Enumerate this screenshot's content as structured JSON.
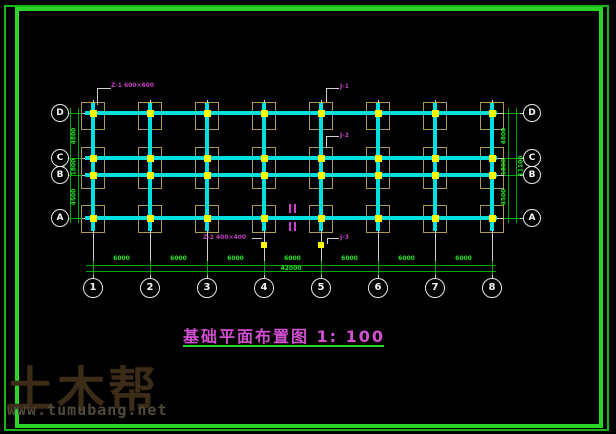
{
  "drawing": {
    "title": "基础平面布置图 1: 100",
    "axes": {
      "columns": [
        "1",
        "2",
        "3",
        "4",
        "5",
        "6",
        "7",
        "8"
      ],
      "rows": [
        "D",
        "C",
        "B",
        "A"
      ]
    },
    "dims": {
      "bottom_bays": [
        "6000",
        "6000",
        "6000",
        "6000",
        "6000",
        "6000",
        "6000"
      ],
      "bottom_total": "42000",
      "side_bays": [
        "4800",
        "1800",
        "4500"
      ],
      "side_total": "11100"
    },
    "callouts": {
      "z1": "Z-1 600×600",
      "z2": "Z-2 400×400",
      "j1": "J-1",
      "j2": "J-2",
      "j3": "J-3"
    },
    "colors": {
      "beam": "#00e0e0",
      "column_square": "#ffff00",
      "pad_outline": "#ab9b55",
      "grid_line": "#cfcfcf",
      "bubble": "#e8e8e8",
      "dim_line": "#00a800",
      "dim_text": "#22e622",
      "border_green": "#2bd42b",
      "callout_magenta": "#c23fc2",
      "title_magenta": "#d24fd2"
    }
  },
  "watermark": {
    "logo": "土木帮",
    "url": "www.tumubang.net"
  }
}
